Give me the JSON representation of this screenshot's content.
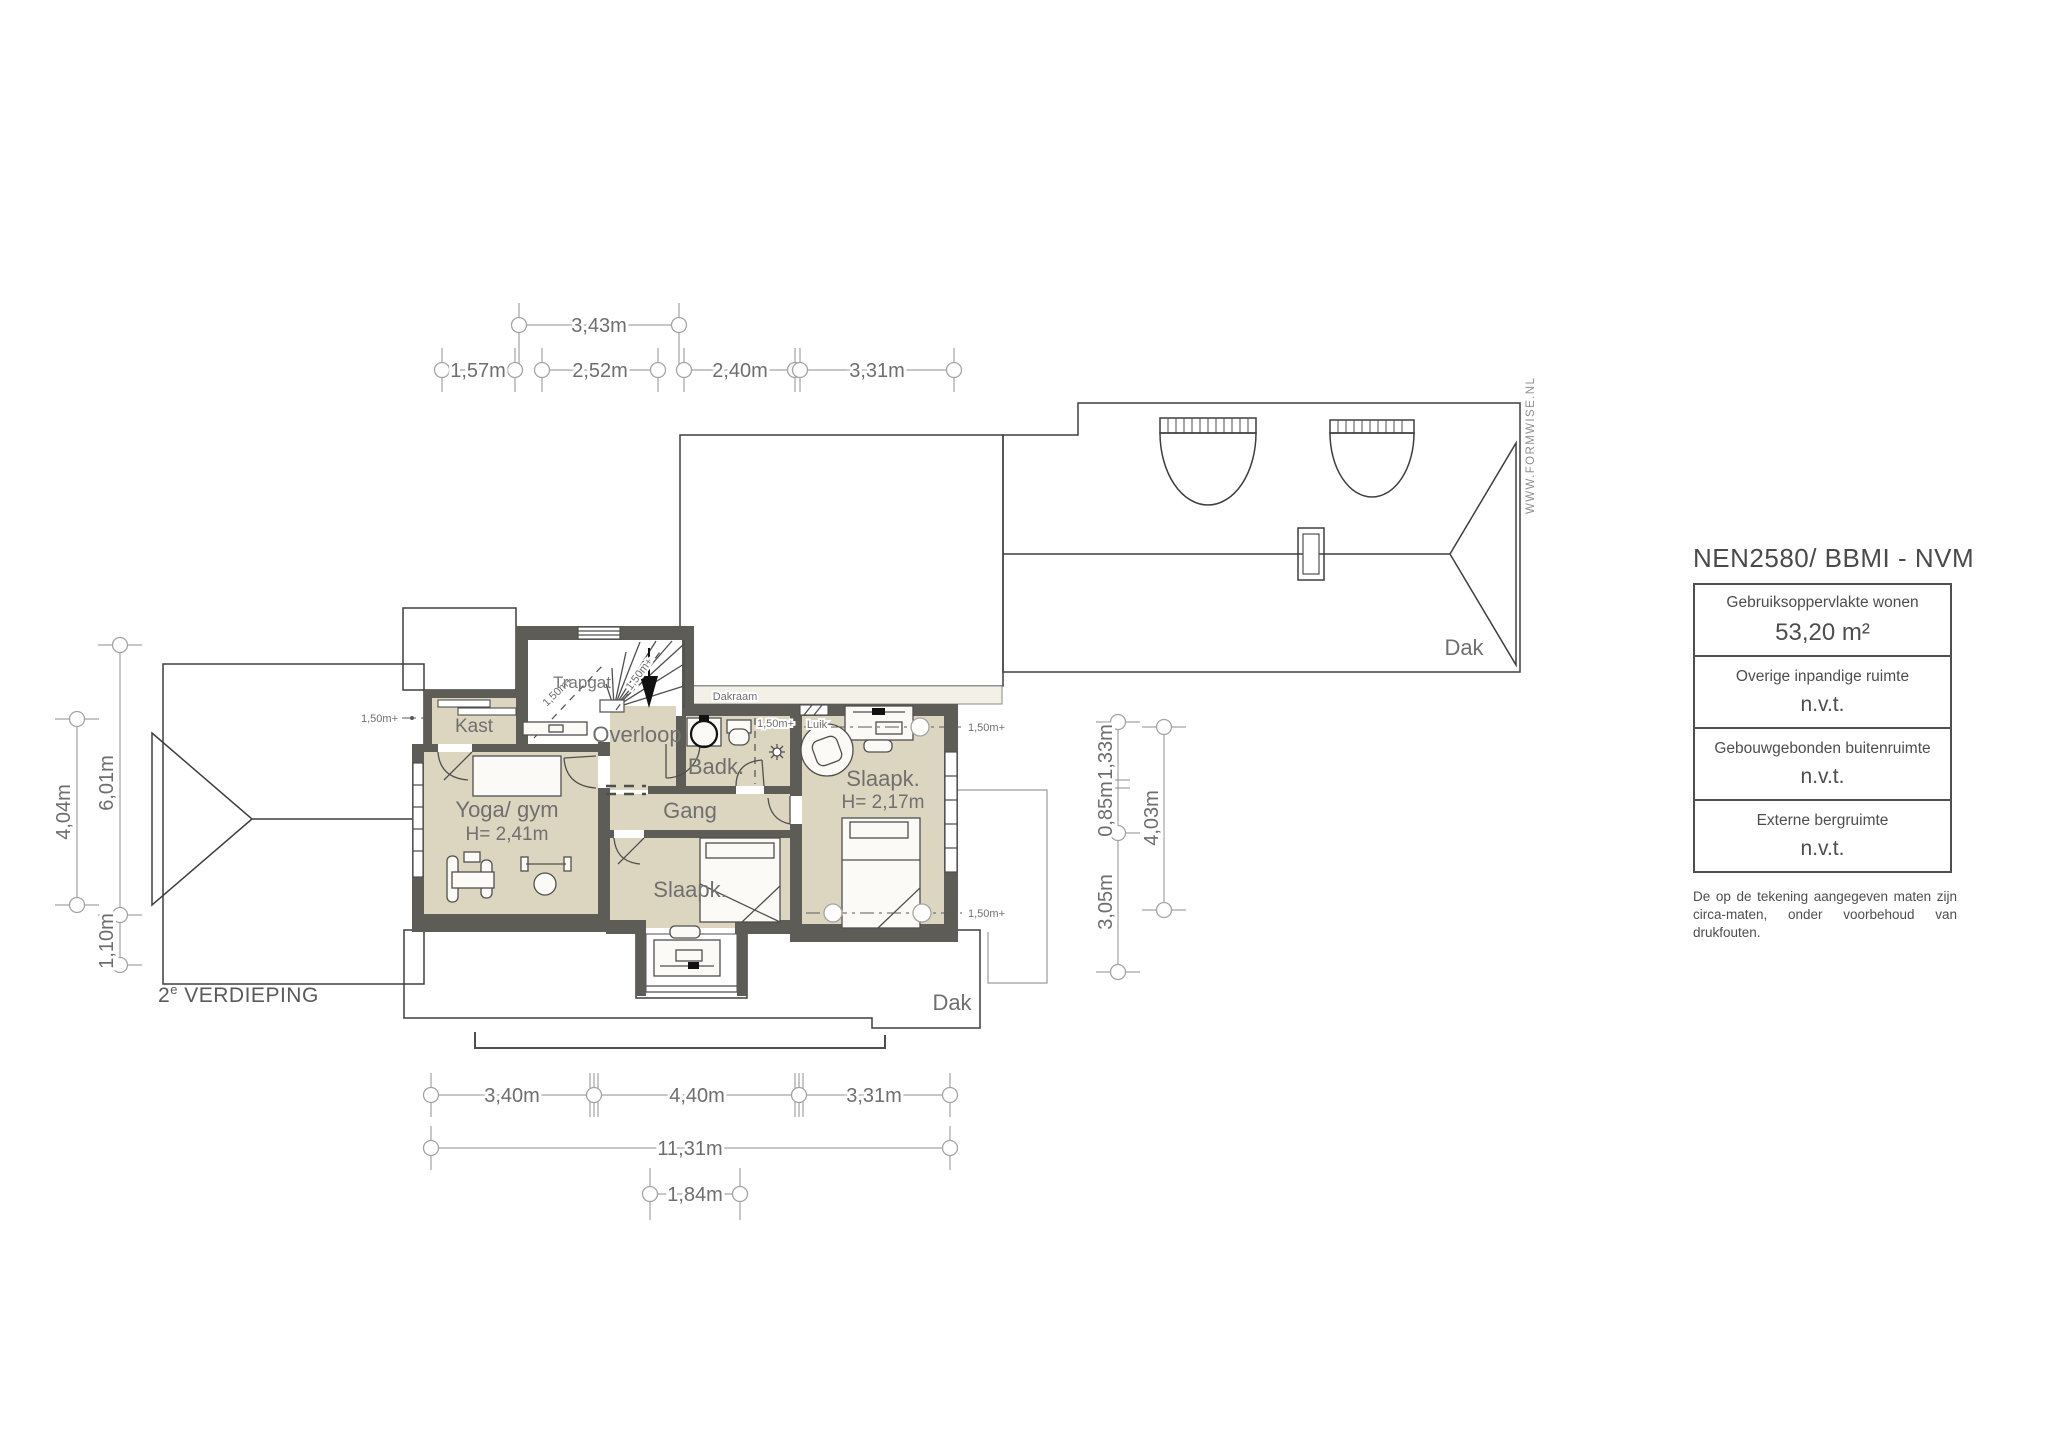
{
  "plan": {
    "floor": {
      "num": "2",
      "sup": "e",
      "name": " VERDIEPING"
    },
    "watermark": "WWW.FORMWISE.NL",
    "rooms": {
      "trapgat": "Trapgat",
      "kast": "Kast",
      "overloop": "Overloop",
      "badk": "Badk.",
      "gang": "Gang",
      "yoga": "Yoga/ gym",
      "yoga_h": "H= 2,41m",
      "slaapk_left": "Slaapk.",
      "slaapk_right": "Slaapk.",
      "slaapk_right_h": "H= 2,17m",
      "dakraam": "Dakraam",
      "luik": "Luik",
      "dak": "Dak"
    },
    "marker_150": "1,50m+",
    "dims": {
      "top_upper": "3,43m",
      "top": [
        "1,57m",
        "2,52m",
        "2,40m",
        "3,31m"
      ],
      "left_outer": "4,04m",
      "left_inner_1": "6,01m",
      "left_inner_2": "1,10m",
      "right_inner": [
        "1,33m",
        "0,85m",
        "3,05m"
      ],
      "right_outer": "4,03m",
      "bottom": [
        "3,40m",
        "4,40m",
        "3,31m"
      ],
      "bottom_total": "11,31m",
      "bottom_nook": "1,84m"
    }
  },
  "panel": {
    "title": "NEN2580/ BBMI - NVM",
    "rows": [
      {
        "label": "Gebruiksoppervlakte wonen",
        "value": "53,20 m²"
      },
      {
        "label": "Overige inpandige ruimte",
        "value": "n.v.t."
      },
      {
        "label": "Gebouwgebonden buitenruimte",
        "value": "n.v.t."
      },
      {
        "label": "Externe bergruimte",
        "value": "n.v.t."
      }
    ],
    "disclaimer": "De op de tekening aangegeven maten zijn circa-maten, onder voorbehoud van drukfouten."
  }
}
